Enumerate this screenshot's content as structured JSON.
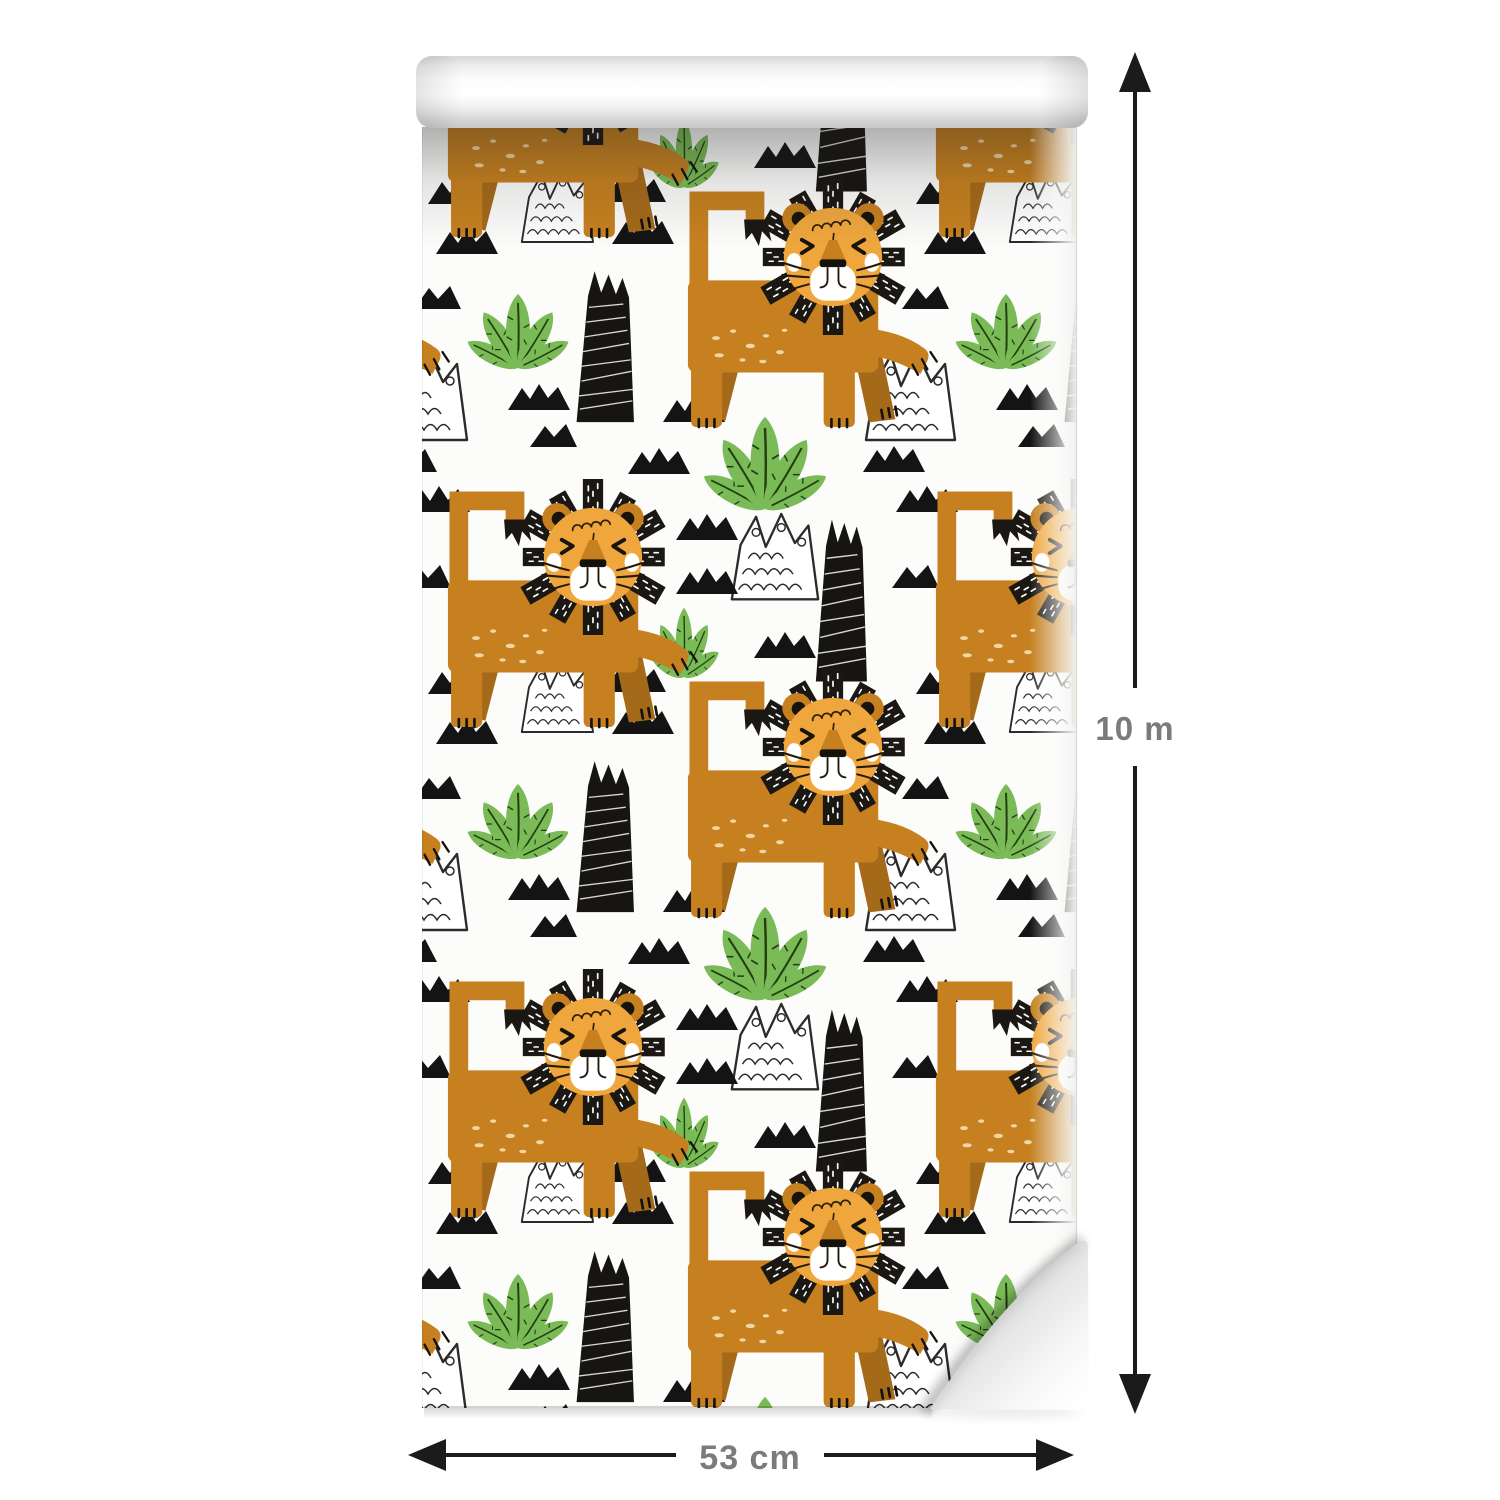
{
  "product_image": {
    "subject": "Wallpaper roll",
    "pattern_description": "Cartoon lions with black manes, green bushes, black spiky trees, doodled white crowns and black triangle clusters on a white background"
  },
  "dimensions": {
    "width_label": "53 cm",
    "length_label": "10 m"
  },
  "pattern": {
    "motifs": [
      "lion-motif",
      "bush-motif",
      "tree-motif",
      "crown-motif",
      "triangle-motif"
    ],
    "colors": {
      "lion_body": "#c6801f",
      "lion_face": "#efa63d",
      "mane_black": "#1b1712",
      "leaf_green": "#7abb57",
      "leaf_vein": "#223f10",
      "motif_black": "#161616",
      "sheet_background": "#fcfcfb"
    }
  },
  "annotation": {
    "line_color": "#1b1b1b",
    "label_color": "#7b7b7b"
  }
}
